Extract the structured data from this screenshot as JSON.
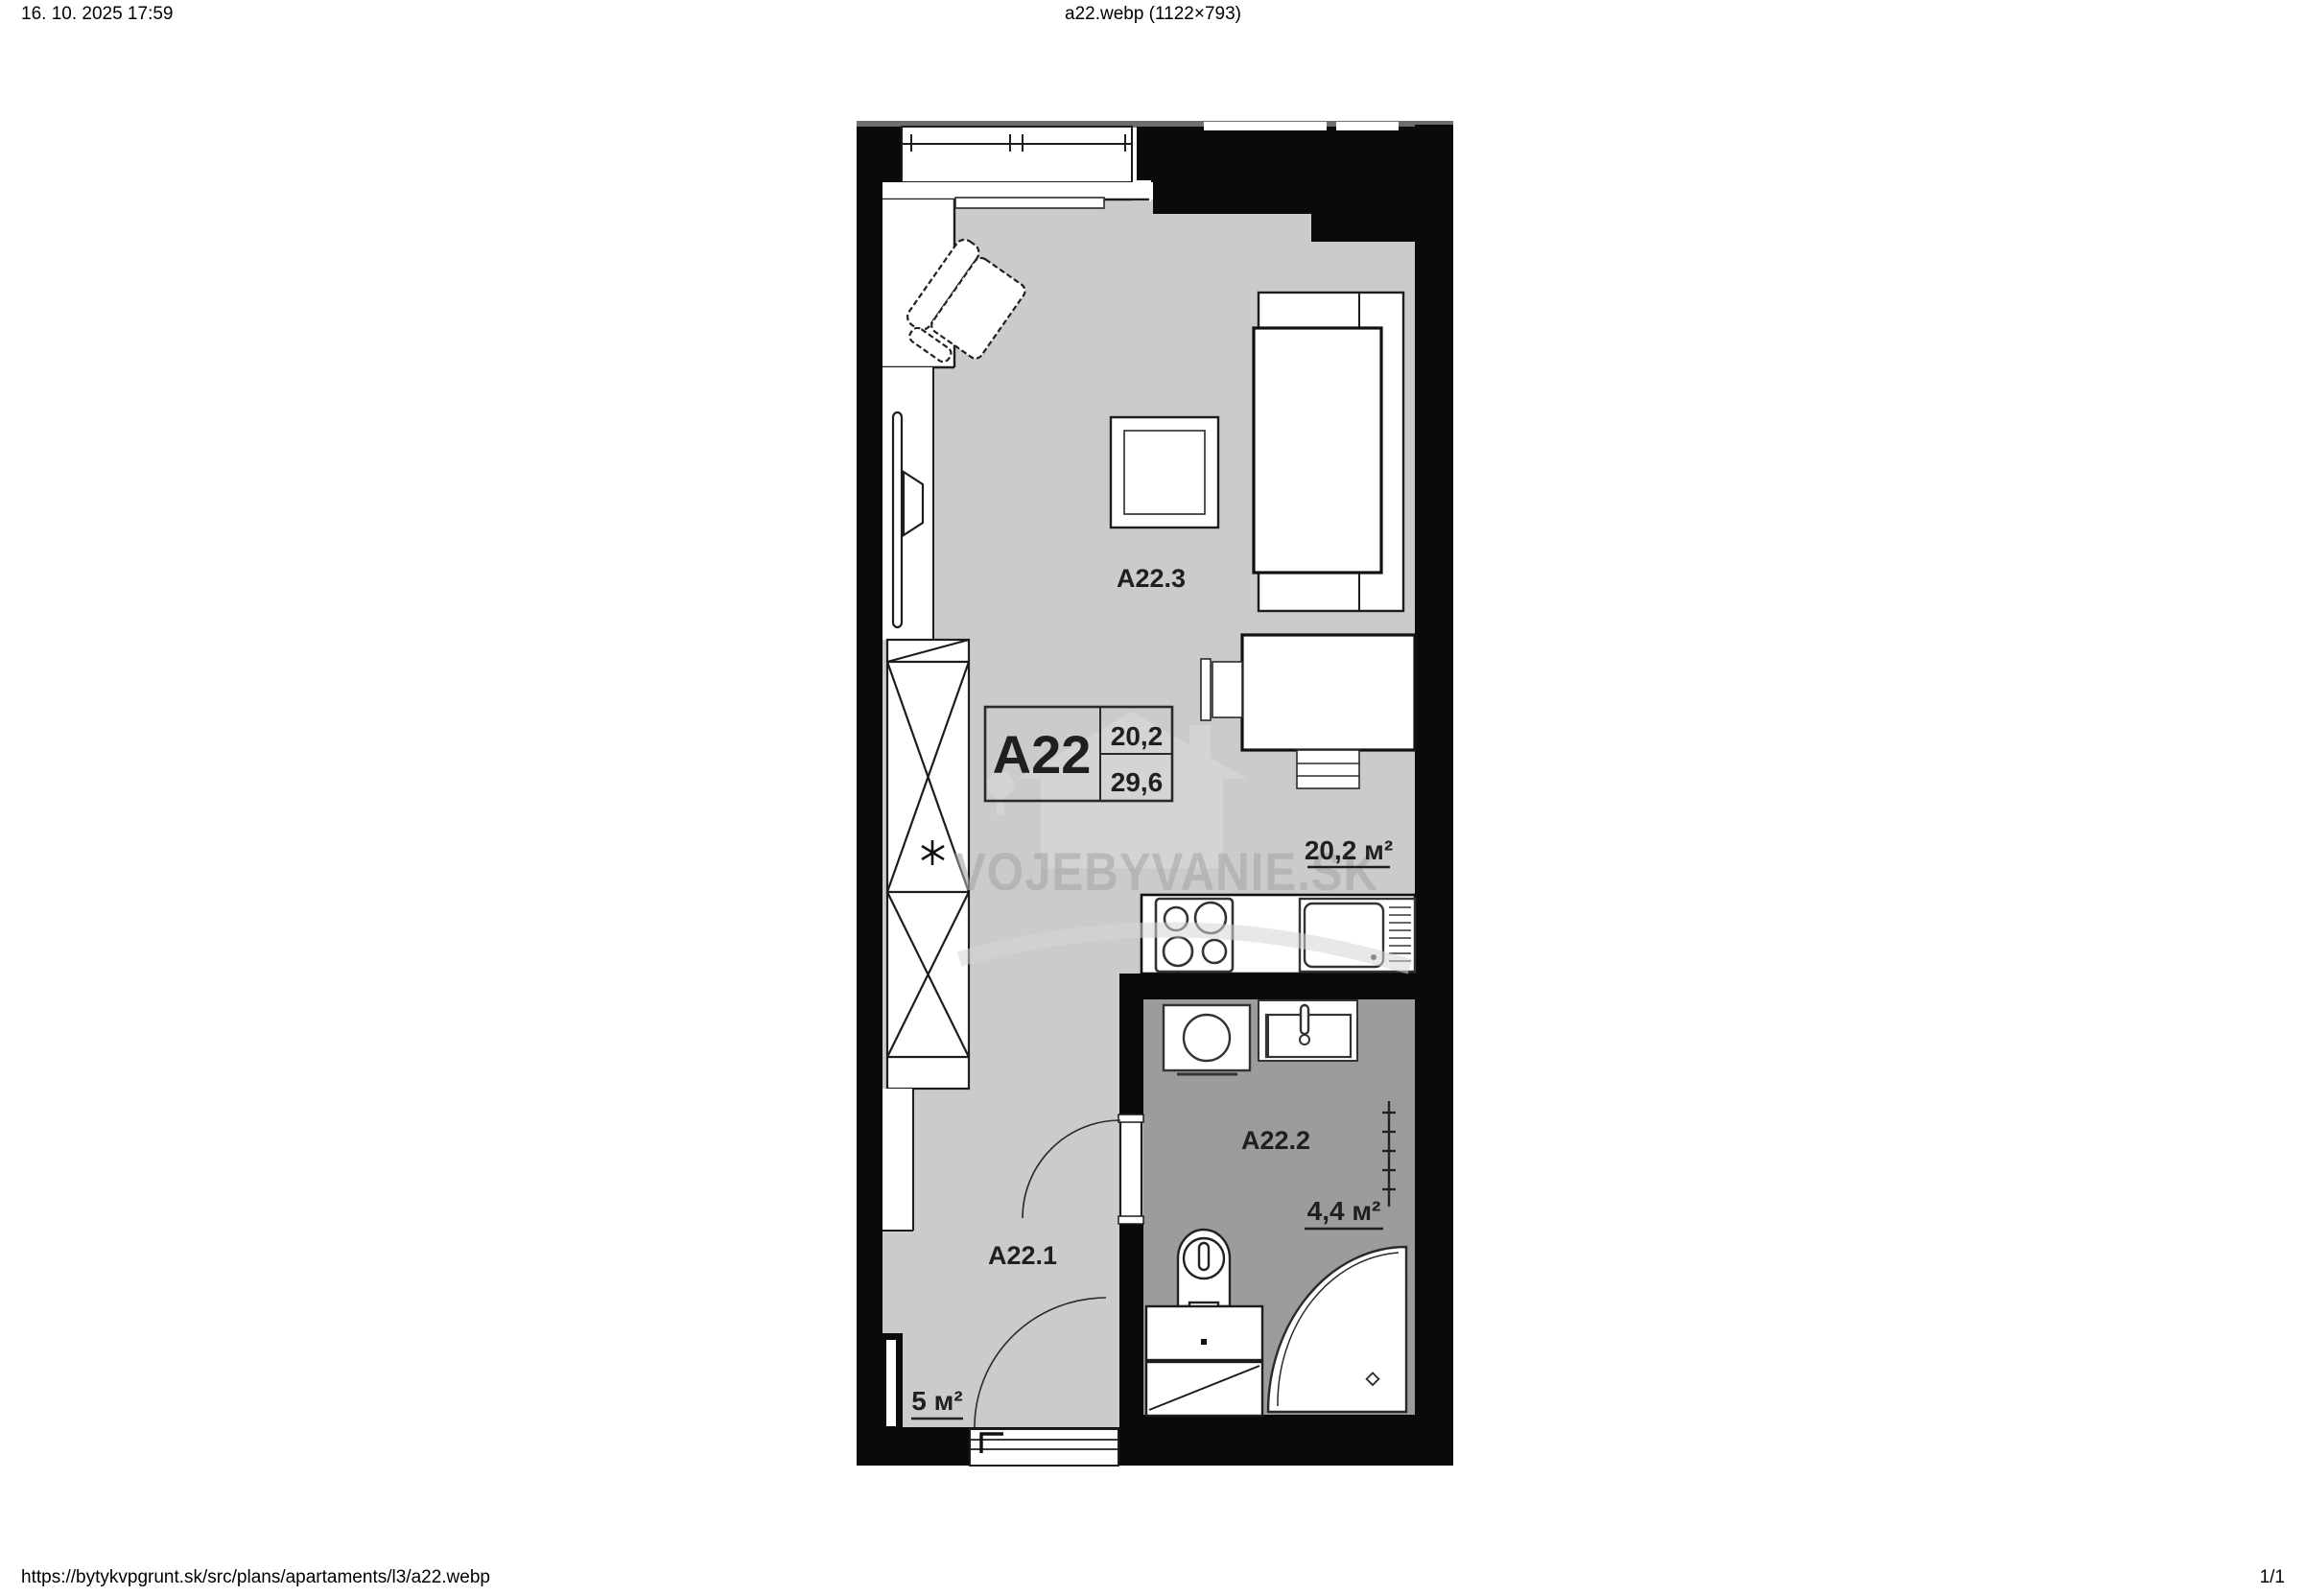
{
  "header": {
    "datetime": "16. 10. 2025 17:59",
    "title": "a22.webp (1122×793)"
  },
  "footer": {
    "url": "https://bytykvpgrunt.sk/src/plans/apartaments/l3/a22.webp",
    "page_indicator": "1/1"
  },
  "plan": {
    "unit": {
      "id": "A22",
      "area_main": "20,2",
      "area_total": "29,6"
    },
    "rooms": {
      "living": {
        "id": "A22.3",
        "area": "20,2 м²"
      },
      "bathroom": {
        "id": "A22.2",
        "area": "4,4 м²"
      },
      "hall": {
        "id": "A22.1",
        "area": "5 м²"
      }
    },
    "watermark": {
      "text": "VOJEBYVANIE.SK"
    },
    "colors": {
      "wall": "#0a0a0a",
      "floor": "#cbcbcb",
      "bathroom_floor": "#9c9c9c",
      "label": "#1f1f1f",
      "watermark": "#a9a9a9"
    }
  }
}
